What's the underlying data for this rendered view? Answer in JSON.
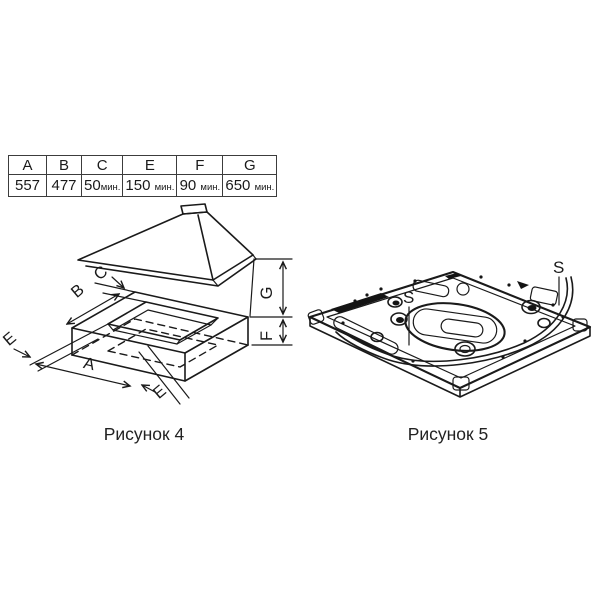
{
  "page": {
    "background": "#ffffff",
    "ink": "#1a1a1a"
  },
  "table": {
    "headers": [
      "A",
      "B",
      "C",
      "E",
      "F",
      "G"
    ],
    "values": [
      {
        "num": "557",
        "unit": ""
      },
      {
        "num": "477",
        "unit": ""
      },
      {
        "num": "50",
        "unit": "мин."
      },
      {
        "num": "150",
        "unit": "мин."
      },
      {
        "num": "90",
        "unit": "мин."
      },
      {
        "num": "650",
        "unit": "мин."
      }
    ]
  },
  "figure4": {
    "caption": "Рисунок 4",
    "dimension_labels": {
      "A": "A",
      "B": "B",
      "C": "C",
      "E_left": "E",
      "E_right": "E",
      "F": "F",
      "G": "G"
    }
  },
  "figure5": {
    "caption": "Рисунок 5",
    "labels": {
      "S_left": "S",
      "S_right": "S"
    }
  }
}
